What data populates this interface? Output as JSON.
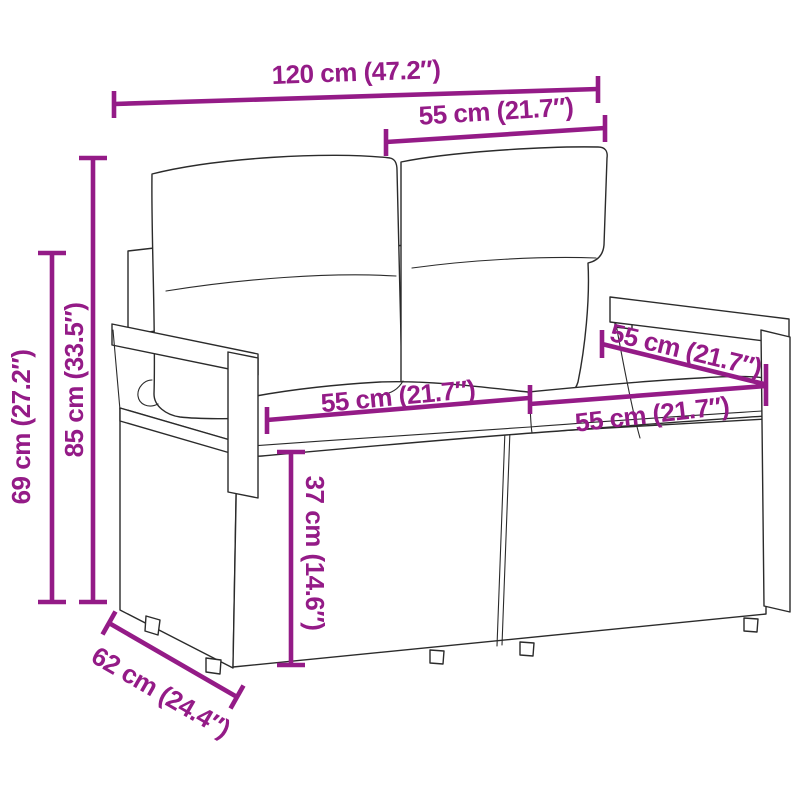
{
  "diagram": {
    "type": "product-dimension-diagram",
    "subject": "poly rattan 2-seater garden sofa with back and seat cushions",
    "accent_color": "#941B87",
    "line_color": "#2b2b2b",
    "background_color": "#ffffff",
    "units": [
      "cm",
      "inches"
    ],
    "labels": {
      "overall_width": "120 cm (47.2″)",
      "back_cushion_width": "55 cm (21.7″)",
      "total_height": "85 cm (33.5″)",
      "armrest_height": "69 cm (27.2″)",
      "seat_width_left": "55 cm (21.7″)",
      "seat_width_right": "55 cm (21.7″)",
      "seat_depth": "55 cm (21.7″)",
      "base_height": "37 cm (14.6″)",
      "side_depth": "62 cm (24.4″)"
    }
  }
}
